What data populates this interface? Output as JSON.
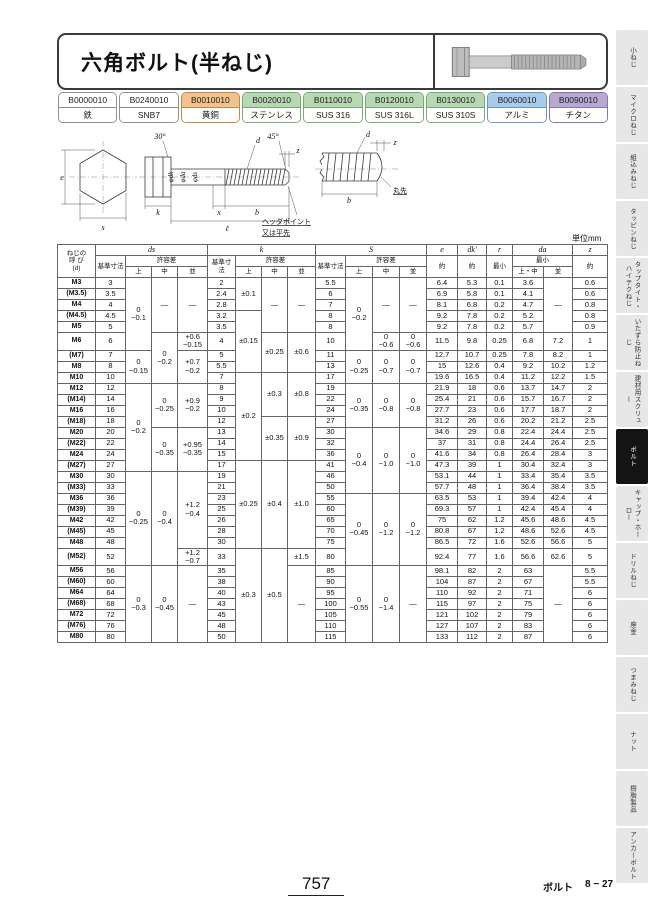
{
  "page": {
    "title": "六角ボルト(半ねじ)",
    "unit": "単位mm",
    "page_number": "757",
    "section_label": "ボルト",
    "section_page": "8 − 27"
  },
  "product_codes": [
    {
      "code": "B0000010",
      "material": "鉄",
      "bg": "#ffffff",
      "border": "#8f8f8f"
    },
    {
      "code": "B0240010",
      "material": "SNB7",
      "bg": "#ffffff",
      "border": "#8f8f8f"
    },
    {
      "code": "B0010010",
      "material": "黄銅",
      "bg": "#f2c28c",
      "border": "#bf8a45"
    },
    {
      "code": "B0020010",
      "material": "ステンレス",
      "bg": "#b6d9b2",
      "border": "#77a877"
    },
    {
      "code": "B0110010",
      "material": "SUS 316",
      "bg": "#b6d9b2",
      "border": "#77a877"
    },
    {
      "code": "B0120010",
      "material": "SUS 316L",
      "bg": "#b6d9b2",
      "border": "#77a877"
    },
    {
      "code": "B0130010",
      "material": "SUS 310S",
      "bg": "#b6d9b2",
      "border": "#77a877"
    },
    {
      "code": "B0060010",
      "material": "アルミ",
      "bg": "#a9cbee",
      "border": "#6d98c4"
    },
    {
      "code": "B0090010",
      "material": "チタン",
      "bg": "#b7a9d2",
      "border": "#8577ad"
    }
  ],
  "drawing": {
    "labels": {
      "deg30": "30°",
      "e": "e",
      "s": "s",
      "dk": "φdk",
      "da": "φda",
      "ds": "φds",
      "d": "d",
      "deg45": "45°",
      "z": "z",
      "k": "k",
      "x": "x",
      "b": "b",
      "l": "ℓ",
      "marusaki": "丸先",
      "head_point": "ヘッダポイント",
      "flat_point": "又は平先"
    }
  },
  "table": {
    "header": {
      "col0": "ねじの\n呼 び\n(d)",
      "ds": "ds",
      "k": "k",
      "s": "S",
      "e": "e",
      "dk": "dk'",
      "r": "r",
      "da": "da",
      "z": "z",
      "base": "基準寸法",
      "tol": "許容差",
      "grades": [
        "上",
        "中",
        "並"
      ],
      "approx": "約",
      "min": "最小",
      "da_cols": [
        "上・中",
        "並"
      ]
    },
    "group_starts": [
      5,
      9,
      14,
      19,
      25
    ],
    "rows": [
      [
        "M3",
        "3",
        [
          "0\n−0.1",
          6
        ],
        [
          "—",
          5
        ],
        [
          "—",
          5
        ],
        "2",
        [
          "±0.1",
          3
        ],
        [
          "—",
          5
        ],
        [
          "—",
          5
        ],
        "5.5",
        [
          "0\n−0.2",
          6
        ],
        [
          "—",
          5
        ],
        [
          "—",
          5
        ],
        "6.4",
        "5.3",
        "0.1",
        "3.6",
        [
          "—",
          5
        ],
        "0.6"
      ],
      [
        "(M3.5)",
        "3.5",
        null,
        null,
        null,
        "2.4",
        null,
        null,
        null,
        "6",
        null,
        null,
        null,
        "6.9",
        "5.8",
        "0.1",
        "4.1",
        null,
        "0.6"
      ],
      [
        "M4",
        "4",
        null,
        null,
        null,
        "2.8",
        null,
        null,
        null,
        "7",
        null,
        null,
        null,
        "8.1",
        "6.8",
        "0.2",
        "4.7",
        null,
        "0.8"
      ],
      [
        "(M4.5)",
        "4.5",
        null,
        null,
        null,
        "3.2",
        [
          "±0.15",
          5
        ],
        null,
        null,
        "8",
        null,
        null,
        null,
        "9.2",
        "7.8",
        "0.2",
        "5.2",
        null,
        "0.8"
      ],
      [
        "M5",
        "5",
        null,
        null,
        null,
        "3.5",
        null,
        null,
        null,
        "8",
        null,
        null,
        null,
        "9.2",
        "7.8",
        "0.2",
        "5.7",
        null,
        "0.9"
      ],
      [
        "M6",
        "6",
        null,
        [
          "0\n−0.2",
          4
        ],
        [
          "+0.6\n−0.15",
          1
        ],
        "4",
        null,
        [
          "±0.25",
          3
        ],
        [
          "±0.6",
          3
        ],
        "10",
        null,
        [
          "0\n−0.6",
          1
        ],
        [
          "0\n−0.6",
          1
        ],
        "11.5",
        "9.8",
        "0.25",
        "6.8",
        "7.2",
        "1"
      ],
      [
        "(M7)",
        "7",
        [
          "0\n−0.15",
          3
        ],
        null,
        [
          "+0.7\n−0.2",
          3
        ],
        "5",
        null,
        null,
        null,
        "11",
        [
          "0\n−0.25",
          3
        ],
        [
          "0\n−0.7",
          3
        ],
        [
          "0\n−0.7",
          3
        ],
        "12.7",
        "10.7",
        "0.25",
        "7.8",
        "8.2",
        "1"
      ],
      [
        "M8",
        "8",
        null,
        null,
        null,
        "5.5",
        null,
        null,
        null,
        "13",
        null,
        null,
        null,
        "15",
        "12.6",
        "0.4",
        "9.2",
        "10.2",
        "1.2"
      ],
      [
        "M10",
        "10",
        null,
        null,
        null,
        "7",
        [
          "±0.2",
          8
        ],
        [
          "±0.3",
          4
        ],
        [
          "±0.8",
          4
        ],
        "17",
        null,
        null,
        null,
        "19.6",
        "16.5",
        "0.4",
        "11.2",
        "12.2",
        "1.5"
      ],
      [
        "M12",
        "12",
        [
          "0\n−0.2",
          8
        ],
        [
          "0\n−0.25",
          4
        ],
        [
          "+0.9\n−0.2",
          4
        ],
        "8",
        null,
        null,
        null,
        "19",
        [
          "0\n−0.35",
          4
        ],
        [
          "0\n−0.8",
          4
        ],
        [
          "0\n−0.8",
          4
        ],
        "21.9",
        "18",
        "0.6",
        "13.7",
        "14.7",
        "2"
      ],
      [
        "(M14)",
        "14",
        null,
        null,
        null,
        "9",
        null,
        null,
        null,
        "22",
        null,
        null,
        null,
        "25.4",
        "21",
        "0.6",
        "15.7",
        "16.7",
        "2"
      ],
      [
        "M16",
        "16",
        null,
        null,
        null,
        "10",
        null,
        null,
        null,
        "24",
        null,
        null,
        null,
        "27.7",
        "23",
        "0.6",
        "17.7",
        "18.7",
        "2"
      ],
      [
        "(M18)",
        "18",
        null,
        null,
        null,
        "12",
        null,
        [
          "±0.35",
          4
        ],
        [
          "±0.9",
          4
        ],
        "27",
        null,
        null,
        null,
        "31.2",
        "26",
        "0.6",
        "20.2",
        "21.2",
        "2.5"
      ],
      [
        "M20",
        "20",
        null,
        [
          "0\n−0.35",
          4
        ],
        [
          "+0.95\n−0.35",
          4
        ],
        "13",
        null,
        null,
        null,
        "30",
        [
          "0\n−0.4",
          6
        ],
        [
          "0\n−1.0",
          6
        ],
        [
          "0\n−1.0",
          6
        ],
        "34.6",
        "29",
        "0.8",
        "22.4",
        "24.4",
        "2.5"
      ],
      [
        "(M22)",
        "22",
        null,
        null,
        null,
        "14",
        null,
        null,
        null,
        "32",
        null,
        null,
        null,
        "37",
        "31",
        "0.8",
        "24.4",
        "26.4",
        "2.5"
      ],
      [
        "M24",
        "24",
        null,
        null,
        null,
        "15",
        null,
        null,
        null,
        "36",
        null,
        null,
        null,
        "41.6",
        "34",
        "0.8",
        "26.4",
        "28.4",
        "3"
      ],
      [
        "(M27)",
        "27",
        null,
        null,
        null,
        "17",
        [
          "±0.25",
          8
        ],
        [
          "±0.4",
          8
        ],
        [
          "±1.0",
          8
        ],
        "41",
        null,
        null,
        null,
        "47.3",
        "39",
        "1",
        "30.4",
        "32.4",
        "3"
      ],
      [
        "M30",
        "30",
        [
          "0\n−0.25",
          8
        ],
        [
          "0\n−0.4",
          8
        ],
        [
          "+1.2\n−0.4",
          7
        ],
        "19",
        null,
        null,
        null,
        "46",
        null,
        null,
        null,
        "53.1",
        "44",
        "1",
        "33.4",
        "35.4",
        "3.5"
      ],
      [
        "(M33)",
        "33",
        null,
        null,
        null,
        "21",
        null,
        null,
        null,
        "50",
        null,
        null,
        null,
        "57.7",
        "48",
        "1",
        "36.4",
        "38.4",
        "3.5"
      ],
      [
        "M36",
        "36",
        null,
        null,
        null,
        "23",
        null,
        null,
        null,
        "55",
        [
          "0\n−0.45",
          6
        ],
        [
          "0\n−1.2",
          6
        ],
        [
          "0\n−1.2",
          6
        ],
        "63.5",
        "53",
        "1",
        "39.4",
        "42.4",
        "4"
      ],
      [
        "(M39)",
        "39",
        null,
        null,
        null,
        "25",
        null,
        null,
        null,
        "60",
        null,
        null,
        null,
        "69.3",
        "57",
        "1",
        "42.4",
        "45.4",
        "4"
      ],
      [
        "M42",
        "42",
        null,
        null,
        null,
        "26",
        null,
        null,
        null,
        "65",
        null,
        null,
        null,
        "75",
        "62",
        "1.2",
        "45.6",
        "48.6",
        "4.5"
      ],
      [
        "(M45)",
        "45",
        null,
        null,
        null,
        "28",
        null,
        null,
        null,
        "70",
        null,
        null,
        null,
        "80.8",
        "67",
        "1.2",
        "48.6",
        "52.6",
        "4.5"
      ],
      [
        "M48",
        "48",
        null,
        null,
        null,
        "30",
        null,
        null,
        null,
        "75",
        null,
        null,
        null,
        "86.5",
        "72",
        "1.6",
        "52.6",
        "56.6",
        "5"
      ],
      [
        "(M52)",
        "52",
        null,
        null,
        [
          "+1.2\n−0.7",
          1
        ],
        "33",
        [
          "±0.3",
          8
        ],
        [
          "±0.5",
          8
        ],
        [
          "±1.5",
          1
        ],
        "80",
        null,
        null,
        null,
        "92.4",
        "77",
        "1.6",
        "56.6",
        "62.6",
        "5"
      ],
      [
        "M56",
        "56",
        [
          "0\n−0.3",
          7
        ],
        [
          "0\n−0.45",
          7
        ],
        [
          "—",
          7
        ],
        "35",
        null,
        null,
        [
          "—",
          7
        ],
        "85",
        [
          "0\n−0.55",
          7
        ],
        [
          "0\n−1.4",
          7
        ],
        [
          "—",
          7
        ],
        "98.1",
        "82",
        "2",
        "63",
        [
          "—",
          7
        ],
        "5.5"
      ],
      [
        "(M60)",
        "60",
        null,
        null,
        null,
        "38",
        null,
        null,
        null,
        "90",
        null,
        null,
        null,
        "104",
        "87",
        "2",
        "67",
        null,
        "5.5"
      ],
      [
        "M64",
        "64",
        null,
        null,
        null,
        "40",
        null,
        null,
        null,
        "95",
        null,
        null,
        null,
        "110",
        "92",
        "2",
        "71",
        null,
        "6"
      ],
      [
        "(M68)",
        "68",
        null,
        null,
        null,
        "43",
        null,
        null,
        null,
        "100",
        null,
        null,
        null,
        "115",
        "97",
        "2",
        "75",
        null,
        "6"
      ],
      [
        "M72",
        "72",
        null,
        null,
        null,
        "45",
        null,
        null,
        null,
        "105",
        null,
        null,
        null,
        "121",
        "102",
        "2",
        "79",
        null,
        "6"
      ],
      [
        "(M76)",
        "76",
        null,
        null,
        null,
        "48",
        null,
        null,
        null,
        "110",
        null,
        null,
        null,
        "127",
        "107",
        "2",
        "83",
        null,
        "6"
      ],
      [
        "M80",
        "80",
        null,
        null,
        null,
        "50",
        null,
        null,
        null,
        "115",
        null,
        null,
        null,
        "133",
        "112",
        "2",
        "87",
        null,
        "6"
      ]
    ]
  },
  "sidebar": {
    "active_index": 7,
    "tabs": [
      "小ねじ",
      "マイクロねじ",
      "組込みねじ",
      "タッピンねじ",
      "タップタイト・ハイテクねじ",
      "いたずら防止ねじ",
      "建材用スクリュー",
      "ボルト",
      "キャップ・ホーロー",
      "ドリルねじ",
      "座金",
      "つまみねじ",
      "ナット",
      "樹脂製品",
      "アンカーボルト"
    ]
  }
}
